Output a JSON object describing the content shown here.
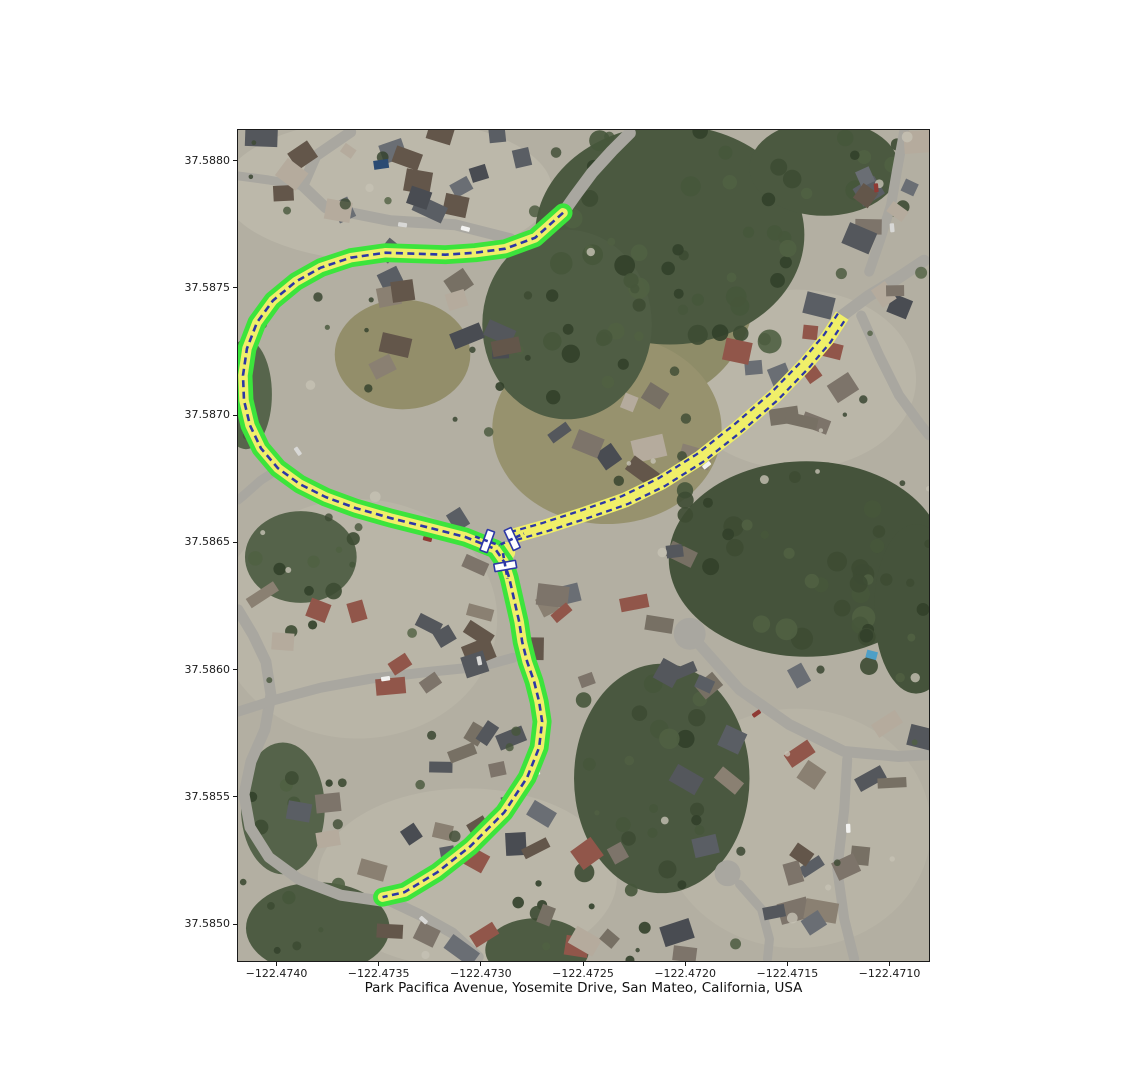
{
  "figure": {
    "xlabel": "Park Pacifica Avenue, Yosemite Drive, San Mateo, California, USA",
    "x_tick_labels": [
      "−122.4740",
      "−122.4735",
      "−122.4730",
      "−122.4725",
      "−122.4720",
      "−122.4715",
      "−122.4710"
    ],
    "y_tick_labels": [
      "37.5880",
      "37.5875",
      "37.5870",
      "37.5865",
      "37.5860",
      "37.5855",
      "37.5850"
    ]
  },
  "map": {
    "colors": {
      "route_highlight_green": "#3ce43c",
      "route_fill_yellow": "#f0ef69",
      "centerline_navy": "#2c37a6",
      "crossing_marker_white": "#ffffff",
      "street_gray": "#a9a7a0"
    },
    "features": {
      "routes": [
        "route-park-pacifica-avenue",
        "route-yosemite-drive"
      ],
      "marker_glyph": "crossing-marker"
    }
  }
}
